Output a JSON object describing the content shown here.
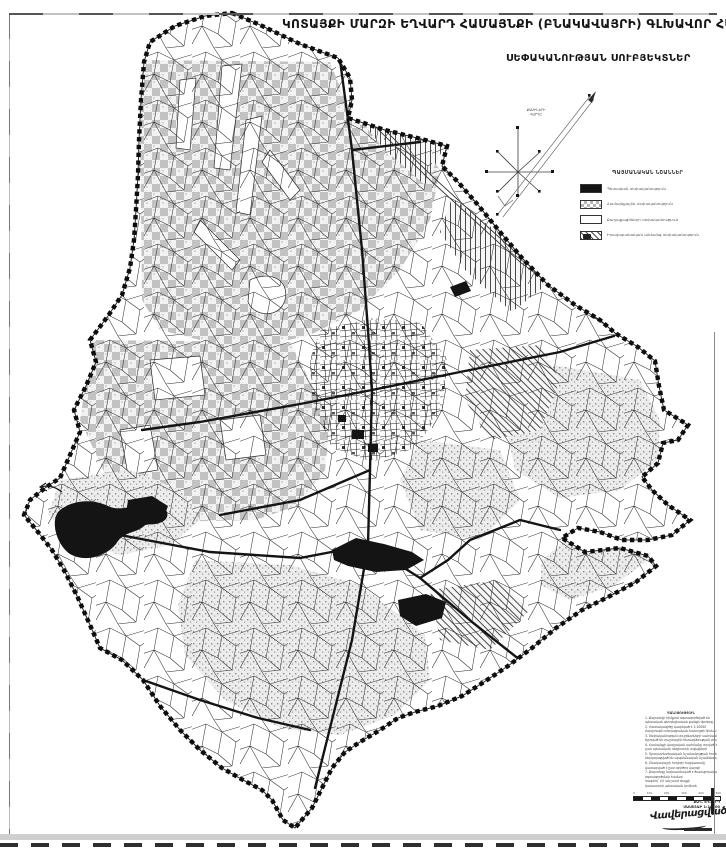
{
  "title": "ԿՈՏԱՅՔԻ ՄԱՐԶԻ ԵՂՎԱՐԴ ՀԱՄԱՅՆՔԻ (ԲՆԱԿԱՎԱՅՐԻ) ԳԼԽԱՎՈՐ ՀԱՏԱԿԱԳԻԾ",
  "subtitle": "ՍԵՓԱԿԱՆՈՒԹՅԱՆ ՍՈՒԲՅԵԿՏՆԵՐ",
  "legend": {
    "title": "ՊԱՅՄԱՆԱԿԱՆ ՆՇԱՆՆԵՐ",
    "items": [
      {
        "swatch": "solid-black",
        "label": "Պետական սեփականություն"
      },
      {
        "swatch": "checker",
        "label": "Համայնքային սեփականություն"
      },
      {
        "swatch": "white",
        "label": "Քաղաքացիների սեփականություն"
      },
      {
        "swatch": "hatched",
        "label": "Իրավաբանական անձանց սեփականություն"
      }
    ]
  },
  "compass": {
    "label_line1": "ՔԱՄԻՆԵՐԻ",
    "label_line2": "ՎԱՐԴԸ"
  },
  "notes": {
    "lines": [
      "ԾԱՆՈԹՈՒԹՅՈՒՆ",
      "1. Քարտեզի հիմքում օգտագործված են",
      "պետական գեոդեզիական ցանցի կետերը",
      "2. Հատակագիծը կազմված է 1:10000",
      "մասշտաբի տեղագրական հանույթի հիման վրա",
      "3. Սեփականության սուբյեկտների սահմանները",
      "ճշտված են դաշտային հետազննության ժամանակ",
      "4. Համայնքի վարչական սահմանը տրված է",
      "ըստ պետական ռեգիստրի տվյալների",
      "5. Գյուղատնտեսական նշանակության հողերը",
      "ներկայացված են պայմանական նշաններով",
      "6. Բնակավայրի հողերի հաշվառումը",
      "կատարված է ըստ գործող կարգի",
      "7. Քարտեզը նախատեսված է ծառայողական",
      "օգտագործման համար",
      "Կազմող՝ ՀՀ անշարժ գույքի",
      "կադաստրի պետական կոմիտե"
    ]
  },
  "scalebar": {
    "ticks": [
      "0",
      "100",
      "200",
      "300",
      "400",
      "500"
    ],
    "caption_line1": "ՔԱՂ. ԵՂՎԱՐԴ",
    "caption_line2": "ՄԱՍՇՏԱԲ 1:10000"
  },
  "signature": {
    "text": "Վավերացված"
  },
  "colors": {
    "ink": "#1a1a1a",
    "checker_gray": "#c2c2c2",
    "stipple_gray": "#8c8c8c",
    "paper": "#ffffff",
    "scan_gray": "#cfcfcf"
  }
}
